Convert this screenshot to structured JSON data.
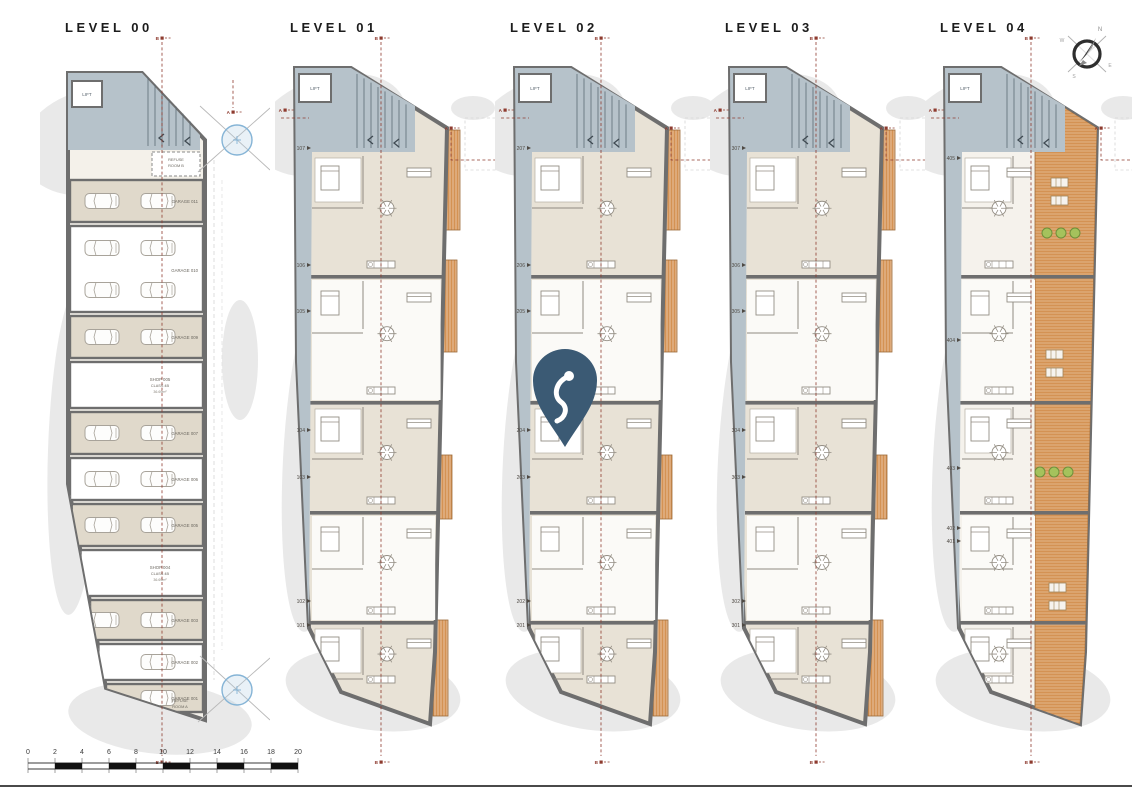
{
  "colors": {
    "walls": "#6e6e6e",
    "room_beige": "#e0d9cb",
    "room_white": "#fbfaf7",
    "interior_base": "#e8e2d6",
    "circulation": "#b6c2ca",
    "balcony": "#d49253",
    "terrace": "#d49253",
    "site_shade": "#e9e9e9",
    "section_marker": "#8e3b2f",
    "pin": "#3b5a74",
    "plant": "#a5c25c",
    "survey": "#85b4d6"
  },
  "compass": {
    "letters": [
      "N",
      "E",
      "S",
      "W"
    ]
  },
  "scale_bar": {
    "ticks": [
      "0",
      "2",
      "4",
      "6",
      "8",
      "10",
      "12",
      "14",
      "16",
      "18",
      "20"
    ]
  },
  "section_markers": {
    "a": "A",
    "b": "B"
  },
  "levels": [
    {
      "title": "LEVEL 00",
      "lift": "LIFT",
      "refuse_room_b": [
        "REFUSE",
        "ROOM B"
      ],
      "refuse_room_a": [
        "REFUSE",
        "ROOM A"
      ],
      "rows": [
        {
          "label": "GARAGE 011"
        },
        {
          "label": "GARAGE 010"
        },
        {
          "label": "GARAGE 009"
        },
        {
          "label": "SHOP 005",
          "sub": "CLASS 4B",
          "area": "36.69m²"
        },
        {
          "label": "GARAGE 007"
        },
        {
          "label": "GARAGE 006"
        },
        {
          "label": "GARAGE 005"
        },
        {
          "label": "SHOP 004",
          "sub": "CLASS 4B",
          "area": "36.69m²"
        },
        {
          "label": "GARAGE 003"
        },
        {
          "label": "GARAGE 002"
        },
        {
          "label": "GARAGE 001"
        }
      ]
    },
    {
      "title": "LEVEL 01",
      "lift": "LIFT",
      "units": [
        "107",
        "106",
        "105",
        "104",
        "103",
        "102",
        "101"
      ]
    },
    {
      "title": "LEVEL 02",
      "lift": "LIFT",
      "units": [
        "207",
        "206",
        "205",
        "204",
        "203",
        "202",
        "201"
      ]
    },
    {
      "title": "LEVEL 03",
      "lift": "LIFT",
      "units": [
        "307",
        "306",
        "305",
        "304",
        "303",
        "302",
        "301"
      ]
    },
    {
      "title": "LEVEL 04",
      "lift": "LIFT",
      "units": [
        "405",
        "404",
        "403",
        "402",
        "401"
      ]
    }
  ]
}
